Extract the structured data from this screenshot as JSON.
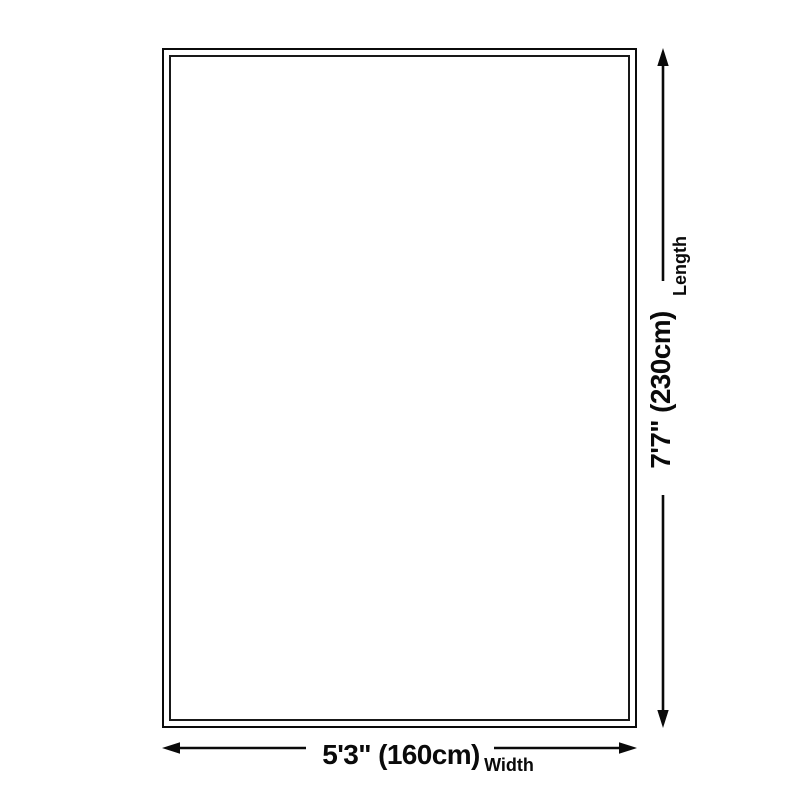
{
  "diagram": {
    "type": "size-dimension-diagram",
    "dimensions": {
      "length": {
        "label": "Length",
        "value": "7'7\" (230cm)"
      },
      "width": {
        "label": "Width",
        "value": "5'3\" (160cm)"
      }
    },
    "colors": {
      "line": "#0a0a0a",
      "text": "#0a0a0a",
      "background": "#ffffff"
    }
  }
}
